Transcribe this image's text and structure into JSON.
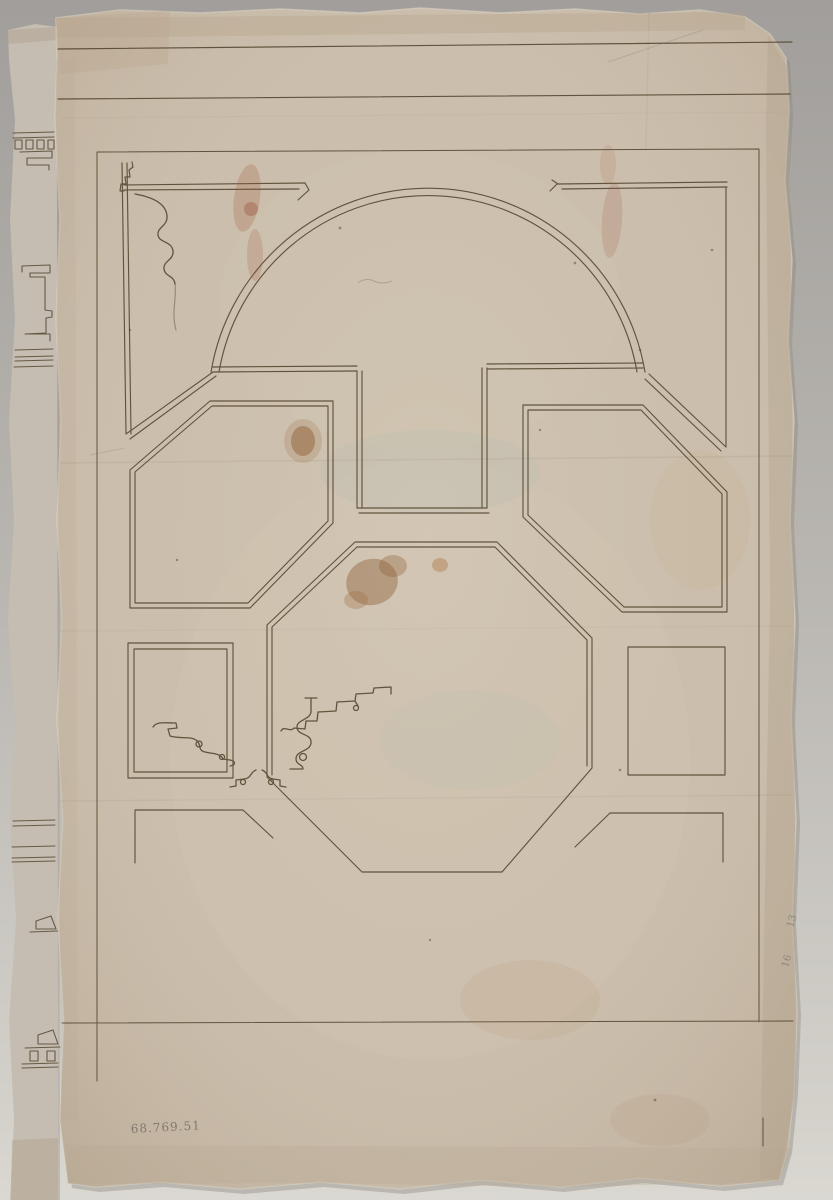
{
  "artwork": {
    "kind": "photograph-of-architectural-drawing",
    "subject": "Plan of a coved ceiling: lunette over a T-panel, flanking chamfered octagon coffers, central octagon, side squares and corner bands, with moulding profile sketches",
    "inscriptions": {
      "accession_number": "68.769.51",
      "right_margin_upper": "13",
      "right_margin_lower": "16"
    },
    "palette": {
      "background_top": "#a19e9b",
      "background_mid": "#bab7b2",
      "background_bottom": "#dbd8d2",
      "paper": "#cbbeac",
      "paper_edge_shadow": "#b1a28c",
      "adjacent_sheet": "#c6bdb2",
      "ink": "#4f4129",
      "pencil": "#706a61",
      "stain": "#8f5c30"
    }
  }
}
